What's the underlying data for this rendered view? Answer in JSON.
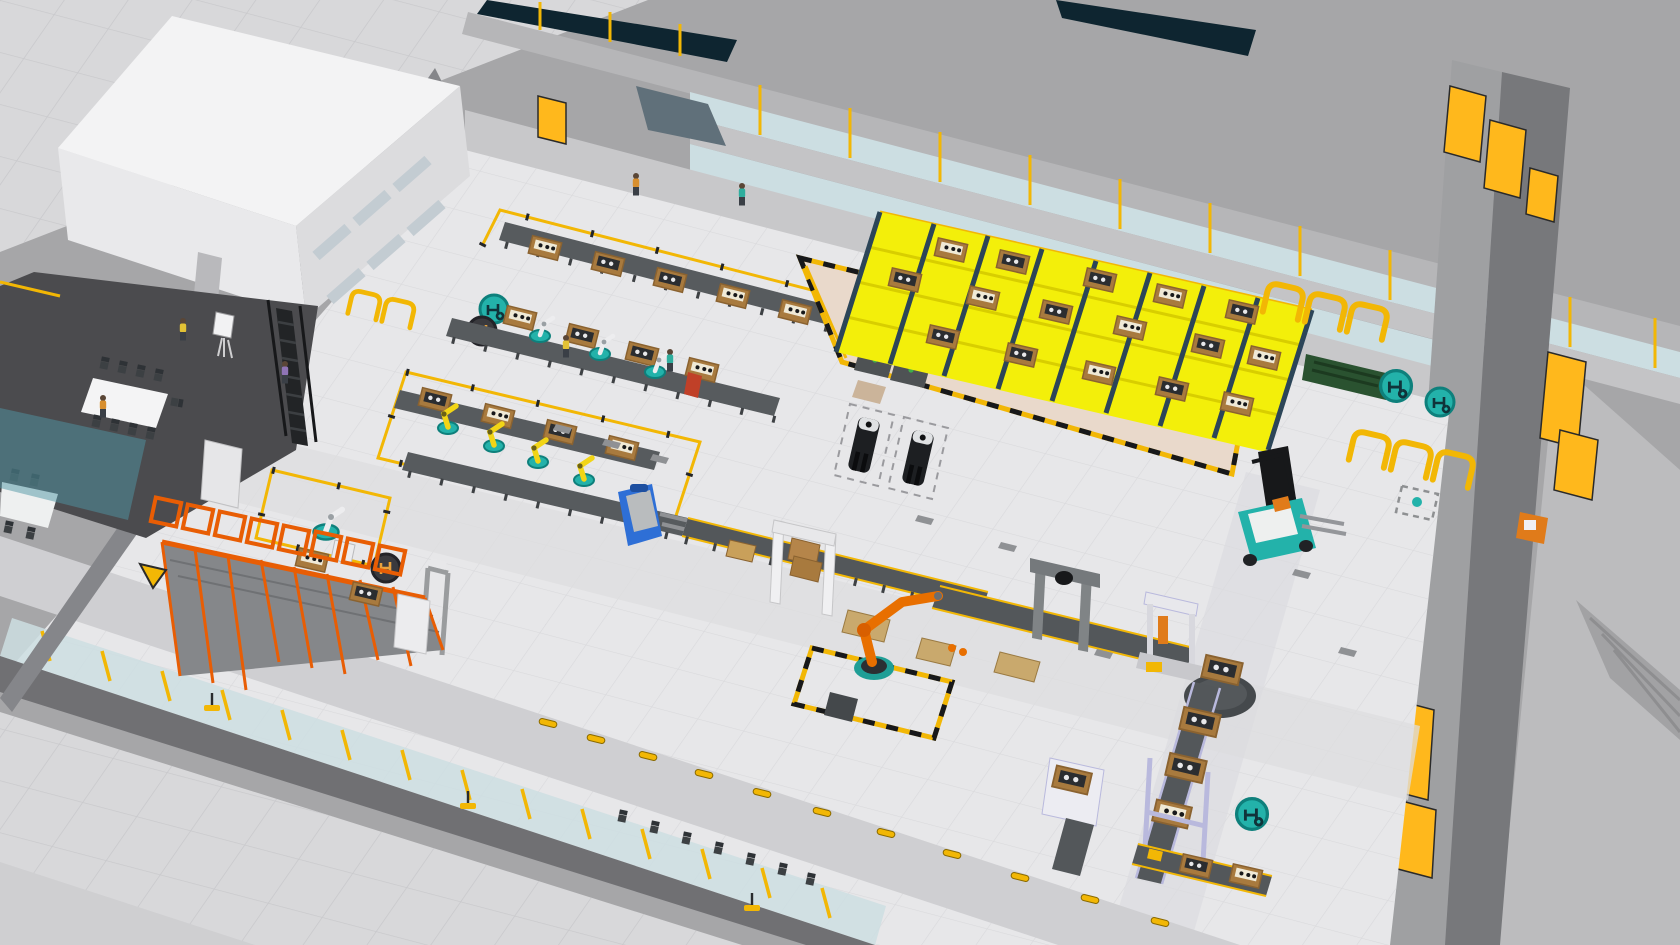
{
  "viewport": {
    "app_label": "3D factory simulation viewport",
    "view_label": "Isometric overview of smart factory floor",
    "width_px": 1680,
    "height_px": 945
  },
  "colors": {
    "backdrop": "#a6a6a8",
    "pavement": "#d8d8da",
    "pavement_grid": "#c9c9cc",
    "floor": "#e7e7e9",
    "floor_grid": "#d9d9dc",
    "aisle": "#cfcfd2",
    "wall_light": "#c8c8ca",
    "wall_mid": "#a9a9ab",
    "wall_dark": "#77787b",
    "roof_gray": "#b6b6b8",
    "ceiling_dark": "#0e2530",
    "office_white": "#f3f3f4",
    "mezz_dark": "#4b4b4e",
    "glass_blue": "#ccdee2",
    "glass_teal": "#4f96a3",
    "safety_yellow": "#f2b705",
    "rack_yellow": "#f3ef0a",
    "door_yellow": "#ffb81c",
    "hazard_black": "#17181a",
    "rack_orange": "#e85d04",
    "robot_orange": "#e86f00",
    "robot_yellow": "#f2d516",
    "teal": "#23b2aa",
    "teal_dark": "#0e807c",
    "navy_post": "#2c4558",
    "crate_wood": "#a87a3e",
    "crate_face": "#8a6230",
    "bench_gray": "#575b5e",
    "conveyor_gray": "#53575a",
    "beige": "#e9d9cb",
    "truck_blue": "#2e6fd6",
    "green_board": "#2a5230",
    "agv_black": "#1d1f22",
    "person_yellow": "#e3c235",
    "person_orange": "#d88f2e",
    "person_teal": "#2fae9e",
    "person_purple": "#8f74b5"
  },
  "scene": {
    "zones": [
      {
        "id": "office-block",
        "label": "Two-story office block"
      },
      {
        "id": "mezzanine",
        "label": "Mezzanine meeting area with conference table"
      },
      {
        "id": "ground-meeting-room",
        "label": "Ground-floor meeting room under glass roof"
      },
      {
        "id": "assembly-lines",
        "label": "Assembly benches with crates and robots (3 rows)"
      },
      {
        "id": "robot-cell",
        "label": "Fenced robot handling cell"
      },
      {
        "id": "pallet-rack",
        "label": "Orange pallet flow rack"
      },
      {
        "id": "flow-rack",
        "label": "Yellow carton flow rack supermarket"
      },
      {
        "id": "dock-area",
        "label": "Marshalling area with hazard boundary"
      },
      {
        "id": "palletizing-line",
        "label": "Roller conveyor palletizing line with robot"
      },
      {
        "id": "packaging-line",
        "label": "Packaging and wrapping conveyor loop"
      },
      {
        "id": "visitor-corridor",
        "label": "Glazed visitor corridor with chairs"
      },
      {
        "id": "upper-walkway",
        "label": "Upper glazed walkway"
      },
      {
        "id": "exterior-yard",
        "label": "Exterior yard and dock ramp"
      }
    ],
    "equipment": [
      {
        "id": "conference-tables",
        "label": "Conference tables",
        "count": 2
      },
      {
        "id": "flipchart",
        "label": "Flipchart easel",
        "count": 1
      },
      {
        "id": "stairs",
        "label": "Mezzanine stairs",
        "count": 1
      },
      {
        "id": "work-benches",
        "label": "Dark work benches",
        "count": 9
      },
      {
        "id": "wooden-crates",
        "label": "Wooden part crates",
        "count": 40
      },
      {
        "id": "cobots",
        "label": "White collaborative robots",
        "count": 3
      },
      {
        "id": "yellow-robots",
        "label": "Yellow industrial robots",
        "count": 4
      },
      {
        "id": "orange-robot-small",
        "label": "Small orange robot",
        "count": 1
      },
      {
        "id": "palletizing-robot",
        "label": "Orange palletizing robot",
        "count": 1
      },
      {
        "id": "palletizer-gantry",
        "label": "Palletizer gantry",
        "count": 1
      },
      {
        "id": "portal-frame",
        "label": "Inspection portal frame",
        "count": 1
      },
      {
        "id": "stretch-wrapper",
        "label": "Stretch wrapper machine",
        "count": 1
      },
      {
        "id": "turntable",
        "label": "Conveyor turntable",
        "count": 1
      },
      {
        "id": "lift-station",
        "label": "Lift transfer station",
        "count": 1
      },
      {
        "id": "processing-machine",
        "label": "Processing machine",
        "count": 2
      },
      {
        "id": "green-noticeboard",
        "label": "Green notice board",
        "count": 1
      },
      {
        "id": "charging-station",
        "label": "Orange charging station",
        "count": 1
      },
      {
        "id": "dock-doors",
        "label": "Yellow dock doors",
        "count": 7
      },
      {
        "id": "speed-bumps",
        "label": "Yellow speed bumps",
        "count": 11
      },
      {
        "id": "sign-stands",
        "label": "Yellow floor sign stands",
        "count": 3
      },
      {
        "id": "warning-sign",
        "label": "Yellow warning sign",
        "count": 1
      }
    ],
    "vehicles": [
      {
        "id": "forklift",
        "label": "Counterbalance forklift",
        "color_name": "teal"
      },
      {
        "id": "pallet-truck",
        "label": "Electric pallet truck",
        "color_name": "blue"
      },
      {
        "id": "agv-1",
        "label": "Pallet truck AGV in staging bay",
        "color_name": "black"
      },
      {
        "id": "agv-2",
        "label": "Pallet truck AGV in staging bay",
        "color_name": "black"
      }
    ],
    "people": [
      {
        "id": "worker-1",
        "shirt": "yellow",
        "location": "mezzanine"
      },
      {
        "id": "worker-2",
        "shirt": "orange",
        "location": "mezzanine table"
      },
      {
        "id": "worker-3",
        "shirt": "purple",
        "location": "mezzanine stairs"
      },
      {
        "id": "worker-4",
        "shirt": "orange",
        "location": "back wall"
      },
      {
        "id": "worker-5",
        "shirt": "teal",
        "location": "back wall"
      },
      {
        "id": "worker-6",
        "shirt": "yellow",
        "location": "assembly row 2"
      },
      {
        "id": "worker-7",
        "shirt": "teal",
        "location": "assembly row 2"
      }
    ],
    "floor_markers": [
      {
        "id": "teal-logo-circles",
        "label": "Teal circular floor logos",
        "count": 4
      },
      {
        "id": "dark-logo-circles",
        "label": "Dark circular floor logos",
        "count": 2
      },
      {
        "id": "parking-bays",
        "label": "Yellow parking bay outlines",
        "count": 8
      },
      {
        "id": "hazard-boundary",
        "label": "Black and yellow dashed boundary",
        "count": 2
      },
      {
        "id": "agv-bays",
        "label": "Dashed AGV staging bays",
        "count": 2
      },
      {
        "id": "dashed-spot",
        "label": "Dashed square spot marker",
        "count": 1
      }
    ]
  }
}
